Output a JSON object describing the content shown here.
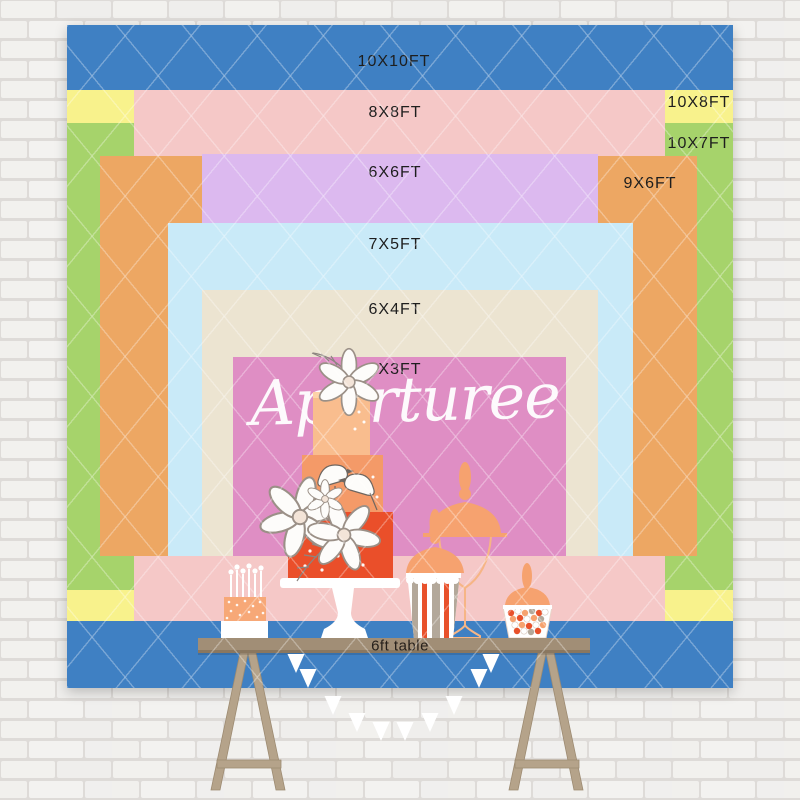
{
  "backdrop": {
    "watermark": "Aperturee",
    "sizes": [
      {
        "label": "10X10FT",
        "color": "#3f80c3"
      },
      {
        "label": "10X8FT",
        "color": "#f8f28c"
      },
      {
        "label": "10X7FT",
        "color": "#a6d36b"
      },
      {
        "label": "8X8FT",
        "color": "#f5c8c7"
      },
      {
        "label": "9X6FT",
        "color": "#eda763"
      },
      {
        "label": "6X6FT",
        "color": "#dcb9ef"
      },
      {
        "label": "7X5FT",
        "color": "#c9eaf8"
      },
      {
        "label": "6X4FT",
        "color": "#ece4d1"
      },
      {
        "label": "5X3FT",
        "color": "#df8ec4"
      }
    ]
  },
  "table": {
    "label": "6ft table",
    "color": "#a18e76"
  },
  "illustration": {
    "items": [
      "candle-cake",
      "tiered-cake",
      "apothecary-jar",
      "popcorn-jar",
      "candy-jar",
      "pennant-banner",
      "trestle-table"
    ]
  }
}
